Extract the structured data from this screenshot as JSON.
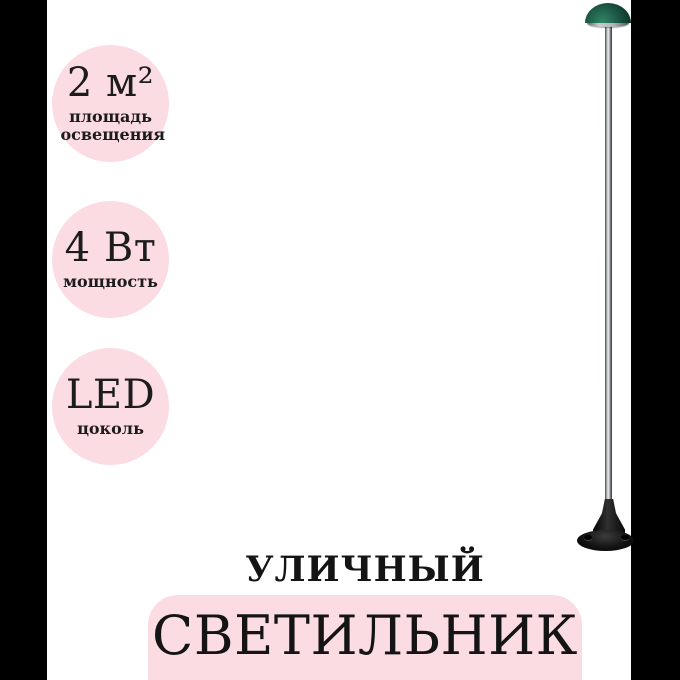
{
  "badges": [
    {
      "value": "2 м²",
      "label": "площадь освещения"
    },
    {
      "value": "4 Вт",
      "label": "мощность"
    },
    {
      "value": "LED",
      "label": "цоколь"
    }
  ],
  "title": {
    "line1": "УЛИЧНЫЙ",
    "line2": "СВЕТИЛЬНИК"
  },
  "colors": {
    "badge_pink": "#fbdce2",
    "band_pink": "#fbdce2",
    "dome_green": "#1e5d49",
    "pole_silver": "#c7cccc",
    "base_black": "#0a0a0a",
    "pillarbox_black": "#000000",
    "text_dark": "#141414",
    "background": "#ffffff"
  }
}
